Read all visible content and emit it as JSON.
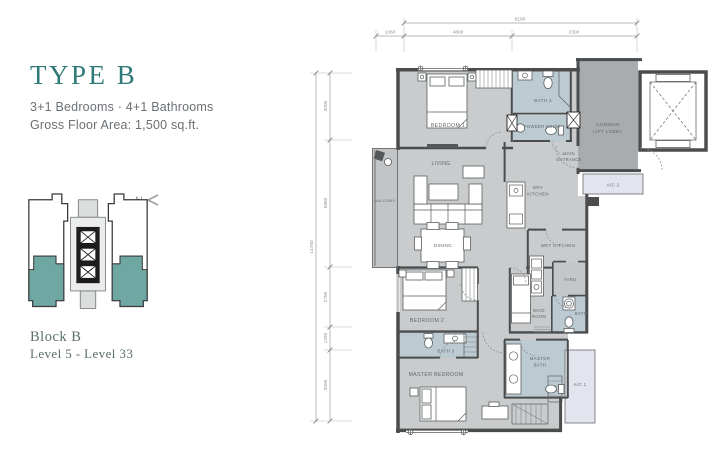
{
  "panel": {
    "title": "TYPE B",
    "subtitle": "3+1 Bedrooms · 4+1 Bathrooms",
    "gfa": "Gross Floor Area: 1,500 sq.ft.",
    "block": "Block B",
    "levels": "Level 5 - Level 33",
    "north": "N"
  },
  "colors": {
    "accent_teal": "#2E7A78",
    "keyplan_teal": "#6FA7A3",
    "wall": "#4A4C4E",
    "room_fill": "#C9CBCC",
    "bath_fill": "#BCCAD2",
    "lobby_fill": "#A8ACAE",
    "ac_fill": "#E3E4ED",
    "balcony_fill": "#C2C4C6",
    "text_gray": "#6B7074"
  },
  "dimensions": {
    "top": {
      "overall": "8180",
      "segments": [
        "1060",
        "4800",
        "2300"
      ]
    },
    "left": {
      "overall": "14750",
      "segments": [
        "3000",
        "5850",
        "2750",
        "1250",
        "3000"
      ]
    }
  },
  "rooms": {
    "bedroom1": "BEDROOM 1",
    "bath2": "BATH 2",
    "powder": "POWDER ROOM",
    "main_1": "MAIN",
    "main_2": "ENTRANCE",
    "lobby_1": "COMMON",
    "lobby_2": "LIFT LOBBY",
    "ac2": "A/C 2",
    "living": "LIVING",
    "balcony": "BALCONY",
    "dining": "DINING",
    "dry_1": "DRY",
    "dry_2": "KITCHEN",
    "wet": "WET KITCHEN",
    "yard": "YARD",
    "maid_bath": "BATH",
    "maid_1": "MAID",
    "maid_2": "ROOM",
    "bedroom2": "BEDROOM 2",
    "bath3": "BATH 3",
    "master_bedroom": "MASTER BEDROOM",
    "mbath_1": "MASTER",
    "mbath_2": "BATH",
    "ac1": "A/C 1"
  }
}
